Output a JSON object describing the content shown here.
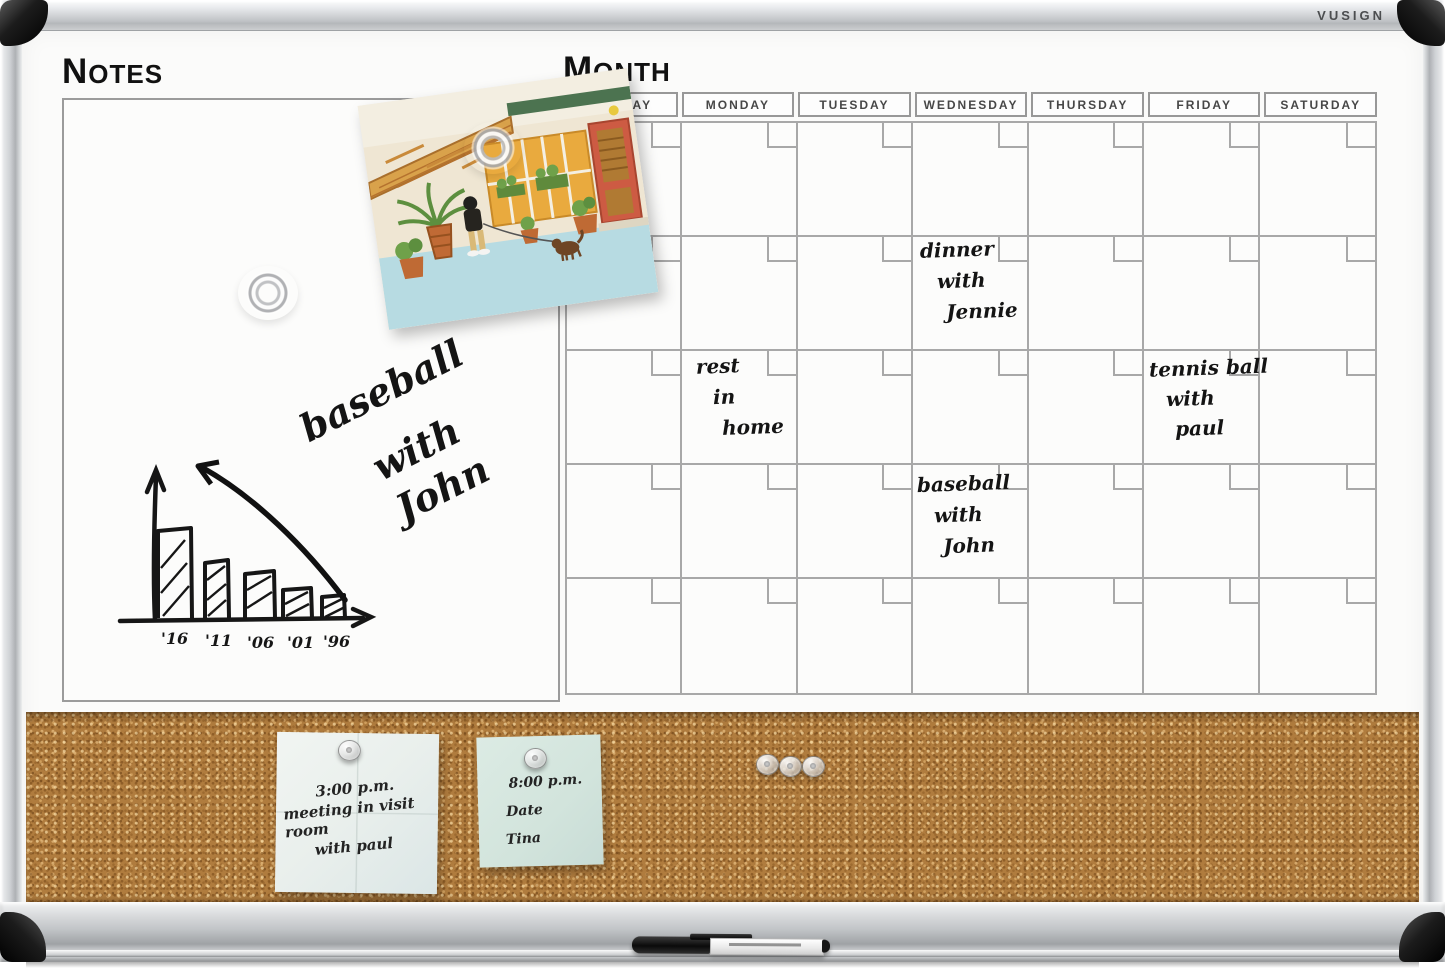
{
  "brand": {
    "logo_text": "VUSIGN"
  },
  "notes_section": {
    "title": "NOTES",
    "handwriting": {
      "line1": "baseball",
      "line2": "with",
      "line3": "John"
    },
    "sketch_chart": {
      "type": "bar",
      "categories": [
        "'16",
        "'11",
        "'06",
        "'01",
        "'96"
      ],
      "values": [
        5,
        3.2,
        2.6,
        1.7,
        1.3
      ],
      "title": "",
      "xlabel": "",
      "ylabel": "",
      "annotations": [
        "hand-drawn rising arrow over descending bars"
      ],
      "grid": false,
      "legend": false
    }
  },
  "calendar_section": {
    "title": "MONTH",
    "day_headers": [
      "SUNDAY",
      "MONDAY",
      "TUESDAY",
      "WEDNESDAY",
      "THURSDAY",
      "FRIDAY",
      "SATURDAY"
    ],
    "rows": 5,
    "columns": 7,
    "entries": [
      {
        "column": "WEDNESDAY",
        "row": 2,
        "lines": [
          "dinner",
          "with",
          "Jennie"
        ]
      },
      {
        "column": "MONDAY",
        "row": 3,
        "lines": [
          "rest",
          "in",
          "home"
        ]
      },
      {
        "column": "FRIDAY",
        "row": 3,
        "lines": [
          "tennis ball",
          "with",
          "paul"
        ]
      },
      {
        "column": "WEDNESDAY",
        "row": 4,
        "lines": [
          "baseball",
          "with",
          "John"
        ]
      }
    ]
  },
  "corkboard": {
    "sticky_notes": [
      {
        "color": "#edf3f0",
        "lines": [
          "3:00 p.m.",
          "meeting in visit room",
          "with paul"
        ]
      },
      {
        "color": "#d4e6de",
        "lines": [
          "8:00 p.m.",
          "Date",
          "Tina"
        ]
      }
    ],
    "loose_pin_count": "3"
  },
  "colors": {
    "frame_silver": "#c7cacd",
    "corner_cap": "#111111",
    "whiteboard": "#fbfbfa",
    "grid_line": "#a8a8a8",
    "cork": "#b07c3e",
    "ink": "#141414"
  }
}
